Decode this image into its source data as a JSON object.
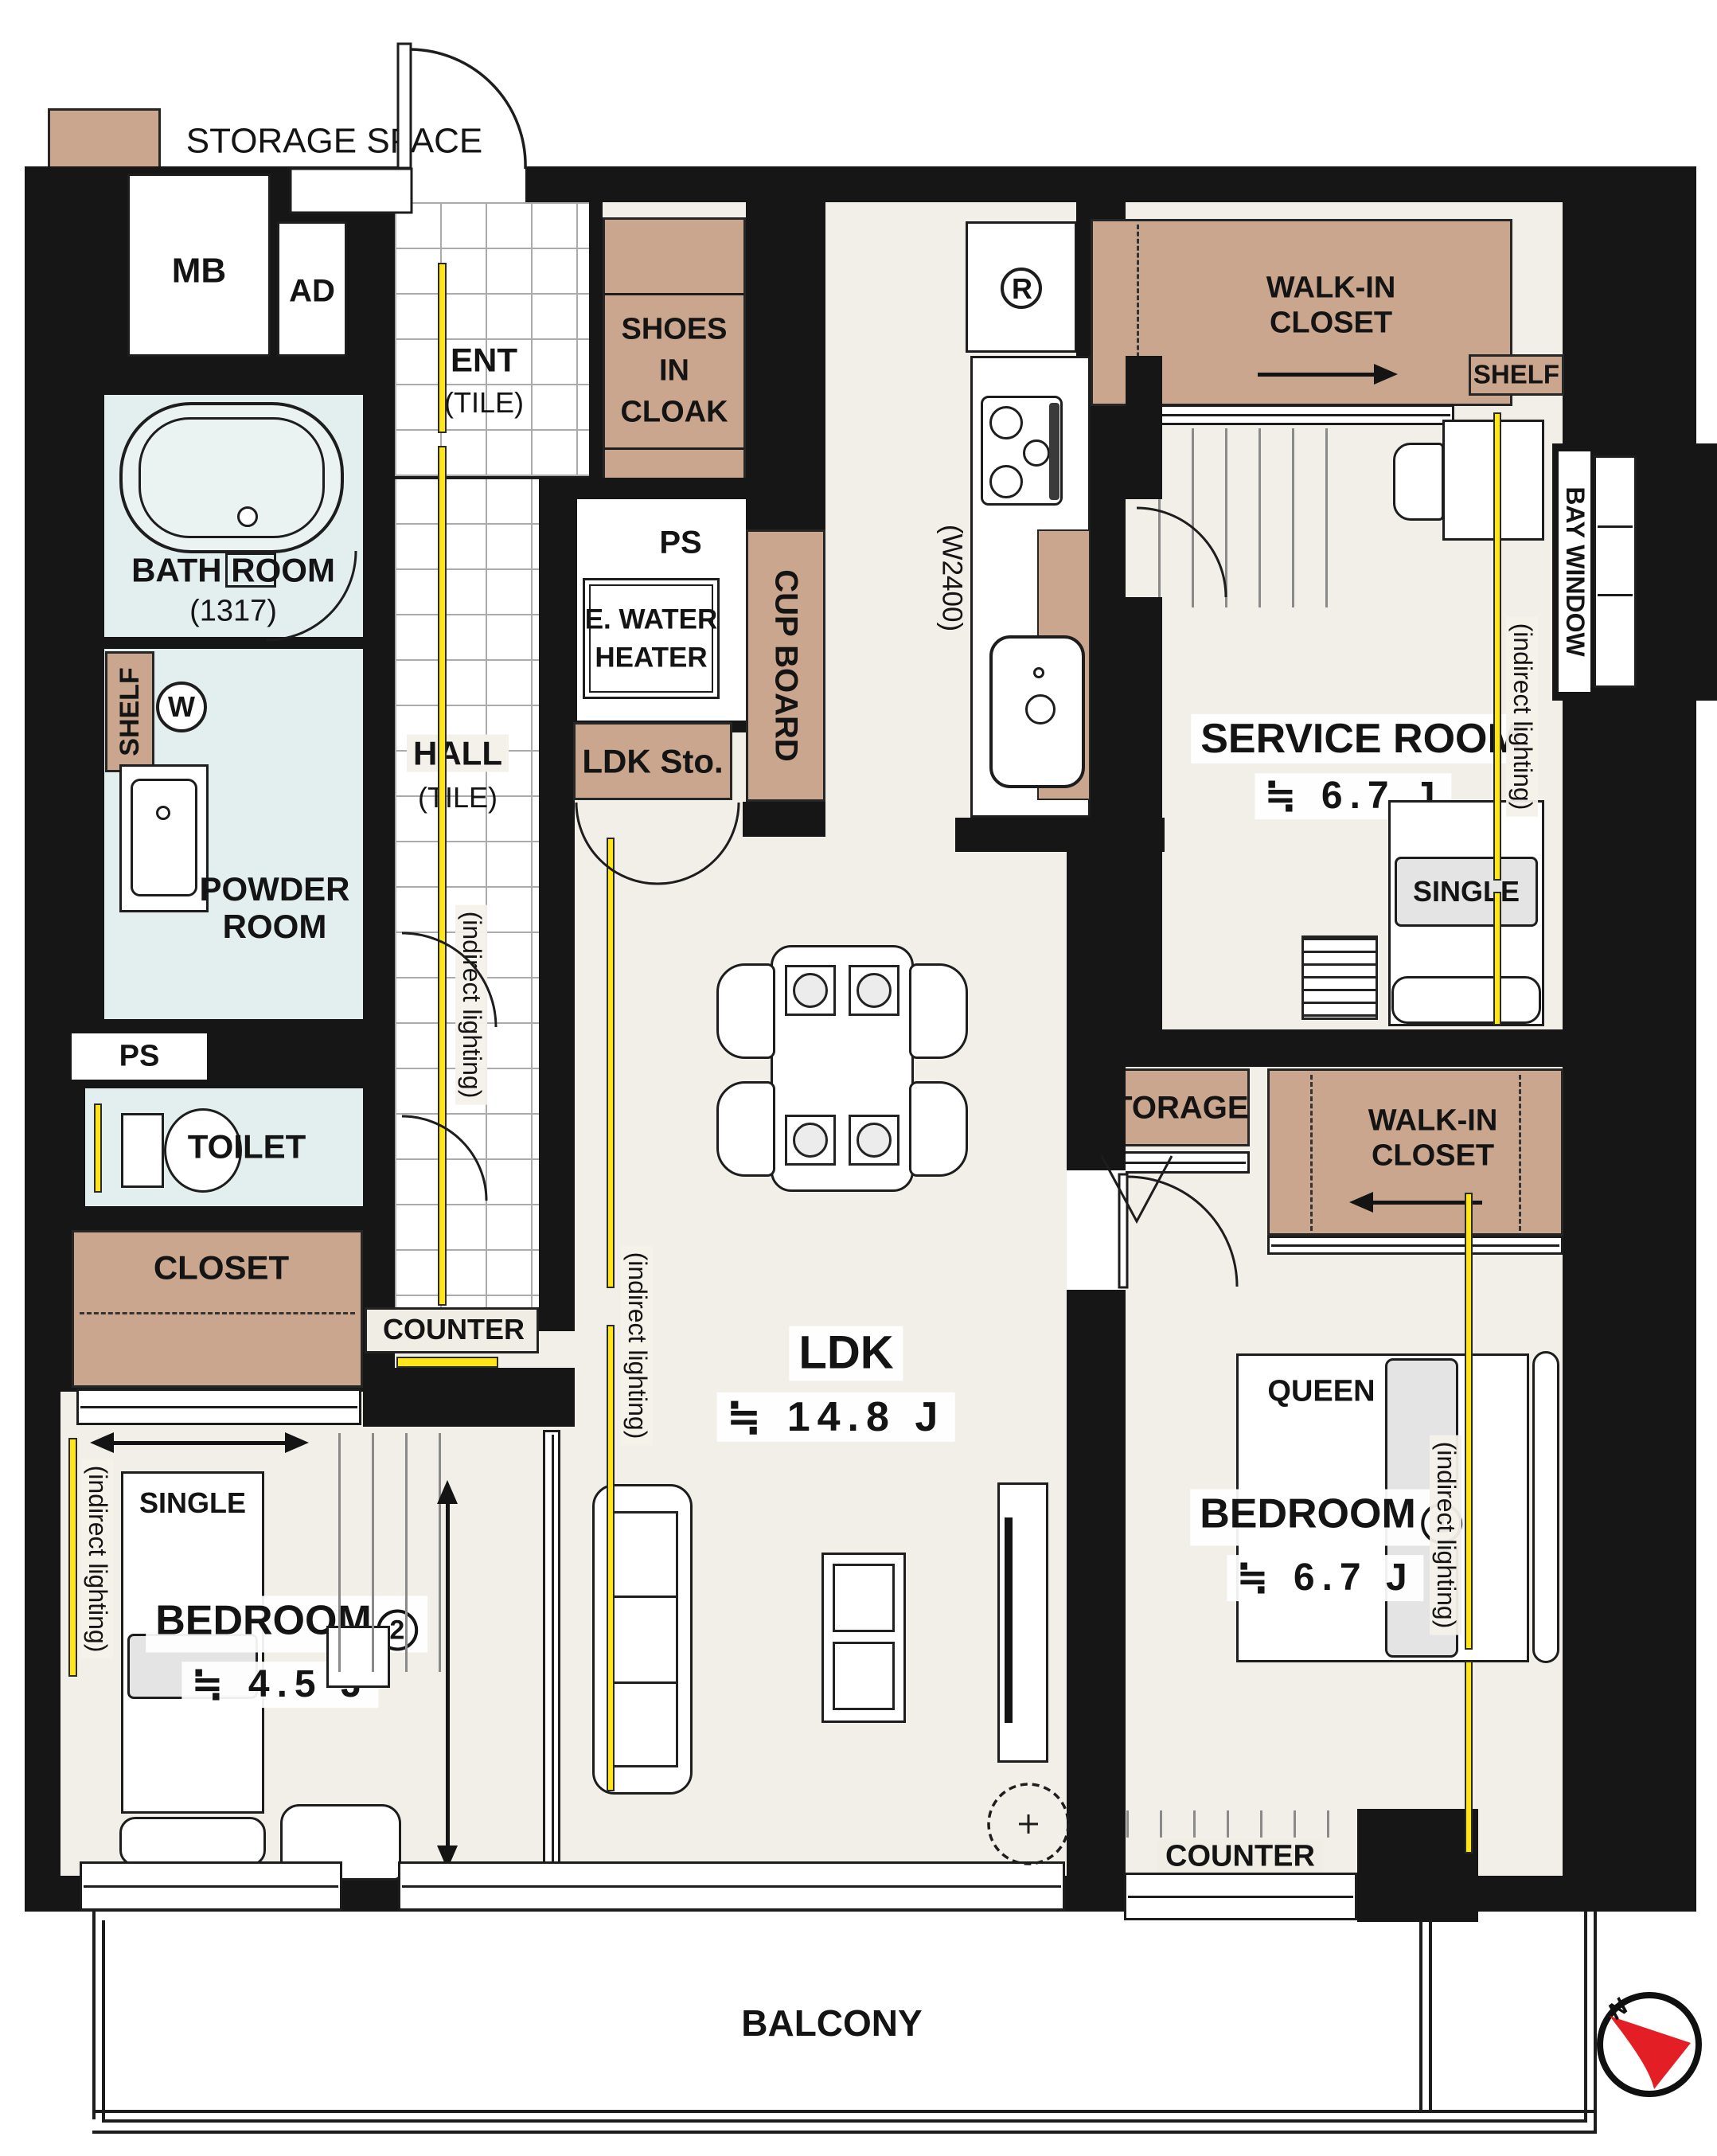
{
  "legend": {
    "label": "STORAGE SPACE",
    "swatch_color": "#C9A68D"
  },
  "colors": {
    "wall": "#161616",
    "floor": "#F2EFE8",
    "wet_floor": "#E3EEEE",
    "storage": "#C9A68D",
    "accent_lighting": "#FFE51A",
    "compass_red": "#E31E24"
  },
  "compass": {
    "n": "N"
  },
  "balcony": {
    "label": "BALCONY"
  },
  "entrance": {
    "label": "ENT",
    "floor": "(TILE)"
  },
  "hall": {
    "label": "HALL",
    "floor": "(TILE)",
    "counter": "COUNTER"
  },
  "utility": {
    "mb": "MB",
    "ad": "AD",
    "ps_top": "PS",
    "ps_side": "PS",
    "water_heater_l1": "E. WATER",
    "water_heater_l2": "HEATER",
    "fridge": "R",
    "washer": "W",
    "kitchen_width": "(W2400)"
  },
  "storage": {
    "shoes_l1": "SHOES",
    "shoes_l2": "IN",
    "shoes_l3": "CLOAK",
    "ldk_sto": "LDK Sto.",
    "cupboard": "CUP BOARD",
    "closet": "CLOSET",
    "storage": "STORAGE",
    "shelf_powder": "SHELF",
    "shelf_service": "SHELF",
    "wic_service_l1": "WALK-IN",
    "wic_service_l2": "CLOSET",
    "wic_bedroom_l1": "WALK-IN",
    "wic_bedroom_l2": "CLOSET"
  },
  "rooms": {
    "bath": {
      "label": "BATH ROOM",
      "size": "(1317)"
    },
    "powder": {
      "l1": "POWDER",
      "l2": "ROOM"
    },
    "toilet": {
      "label": "TOILET"
    },
    "ldk": {
      "label": "LDK",
      "size": "≒ 14.8 J"
    },
    "service": {
      "label": "SERVICE ROOM",
      "size": "≒ 6.7 J",
      "bed": "SINGLE"
    },
    "bedroom1": {
      "name": "BEDROOM",
      "number": "1",
      "size": "≒ 6.7 J",
      "bed": "QUEEN",
      "counter": "COUNTER"
    },
    "bedroom2": {
      "name": "BEDROOM",
      "number": "2",
      "size": "≒ 4.5 J",
      "bed": "SINGLE"
    }
  },
  "notes": {
    "indirect": "(indirect lighting)",
    "bay_window": "BAY WINDOW"
  }
}
